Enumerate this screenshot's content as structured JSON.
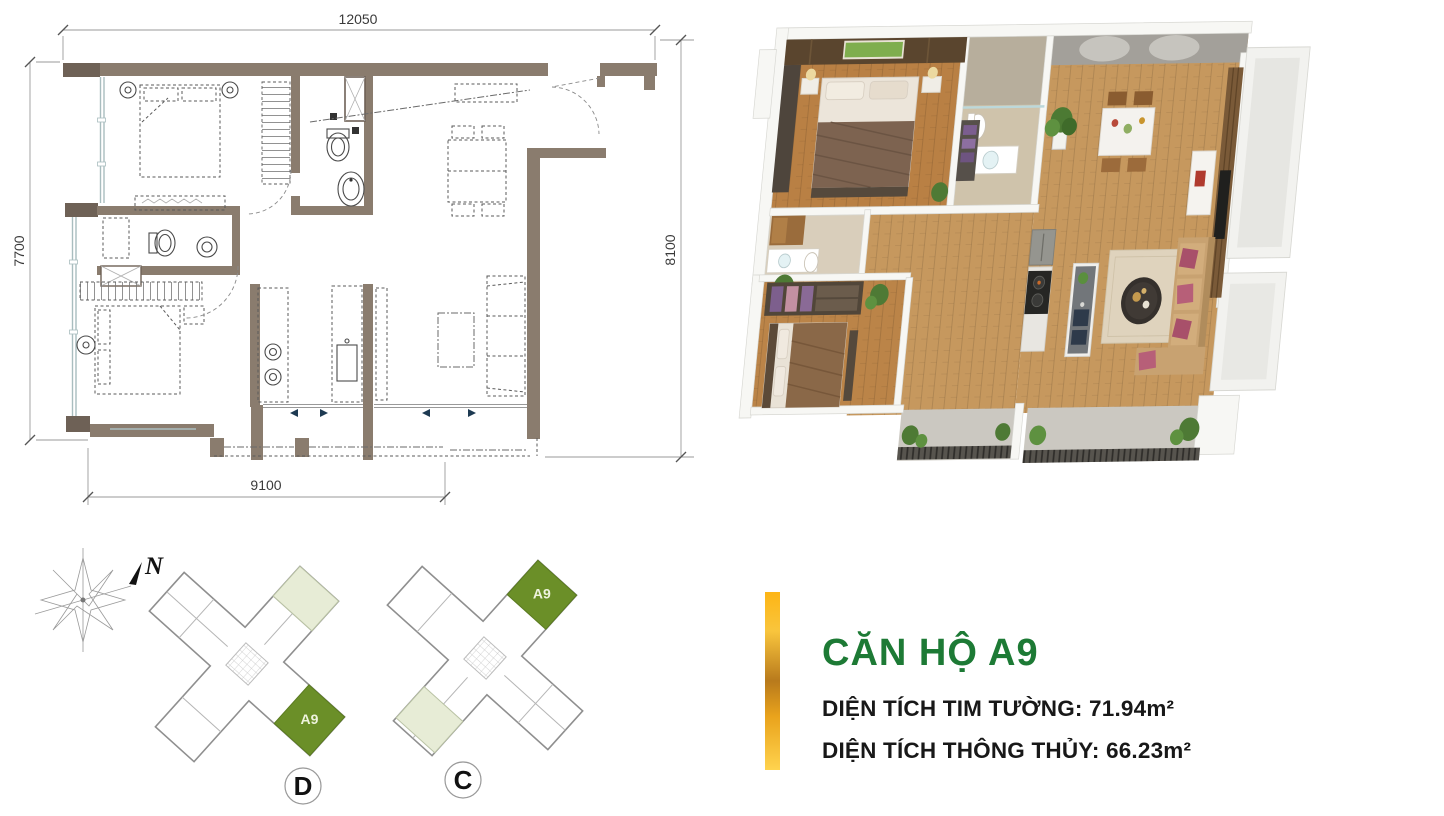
{
  "floor_plan": {
    "dimensions": {
      "top": "12050",
      "left": "7700",
      "right": "8100",
      "bottom": "9100"
    }
  },
  "site_plan": {
    "north_label": "N",
    "buildings": [
      {
        "label": "D",
        "highlighted_unit": "A9"
      },
      {
        "label": "C",
        "highlighted_unit": "A9"
      }
    ]
  },
  "info": {
    "title": "CĂN HỘ A9",
    "lines": [
      {
        "label": "DIỆN TÍCH TIM TƯỜNG:",
        "value": "71.94m²"
      },
      {
        "label": "DIỆN TÍCH THÔNG THỦY:",
        "value": "66.23m²"
      }
    ]
  },
  "colors": {
    "title_green": "#1d7a35",
    "unit_green": "#6b8f28",
    "unit_pale_green": "#e7ecd6",
    "accent_gold": "#f0a818",
    "wall_brown": "#8a7c6e",
    "wood_floor": "#c6985e"
  }
}
